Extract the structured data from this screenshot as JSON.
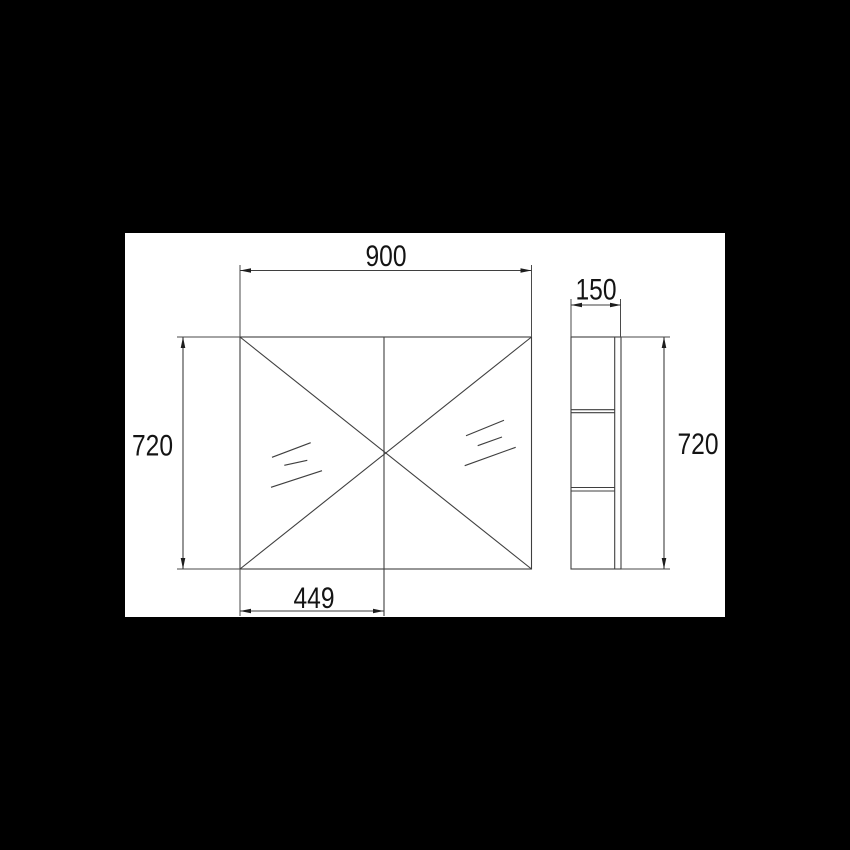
{
  "scene": {
    "background_color": "#000000",
    "sheet_color": "#ffffff",
    "line_color": "#3f3f3f",
    "text_color": "#141414"
  },
  "drawing": {
    "dimensions": {
      "front_width": "900",
      "front_height": "720",
      "side_depth": "150",
      "side_height": "720",
      "left_door_width": "449"
    }
  }
}
